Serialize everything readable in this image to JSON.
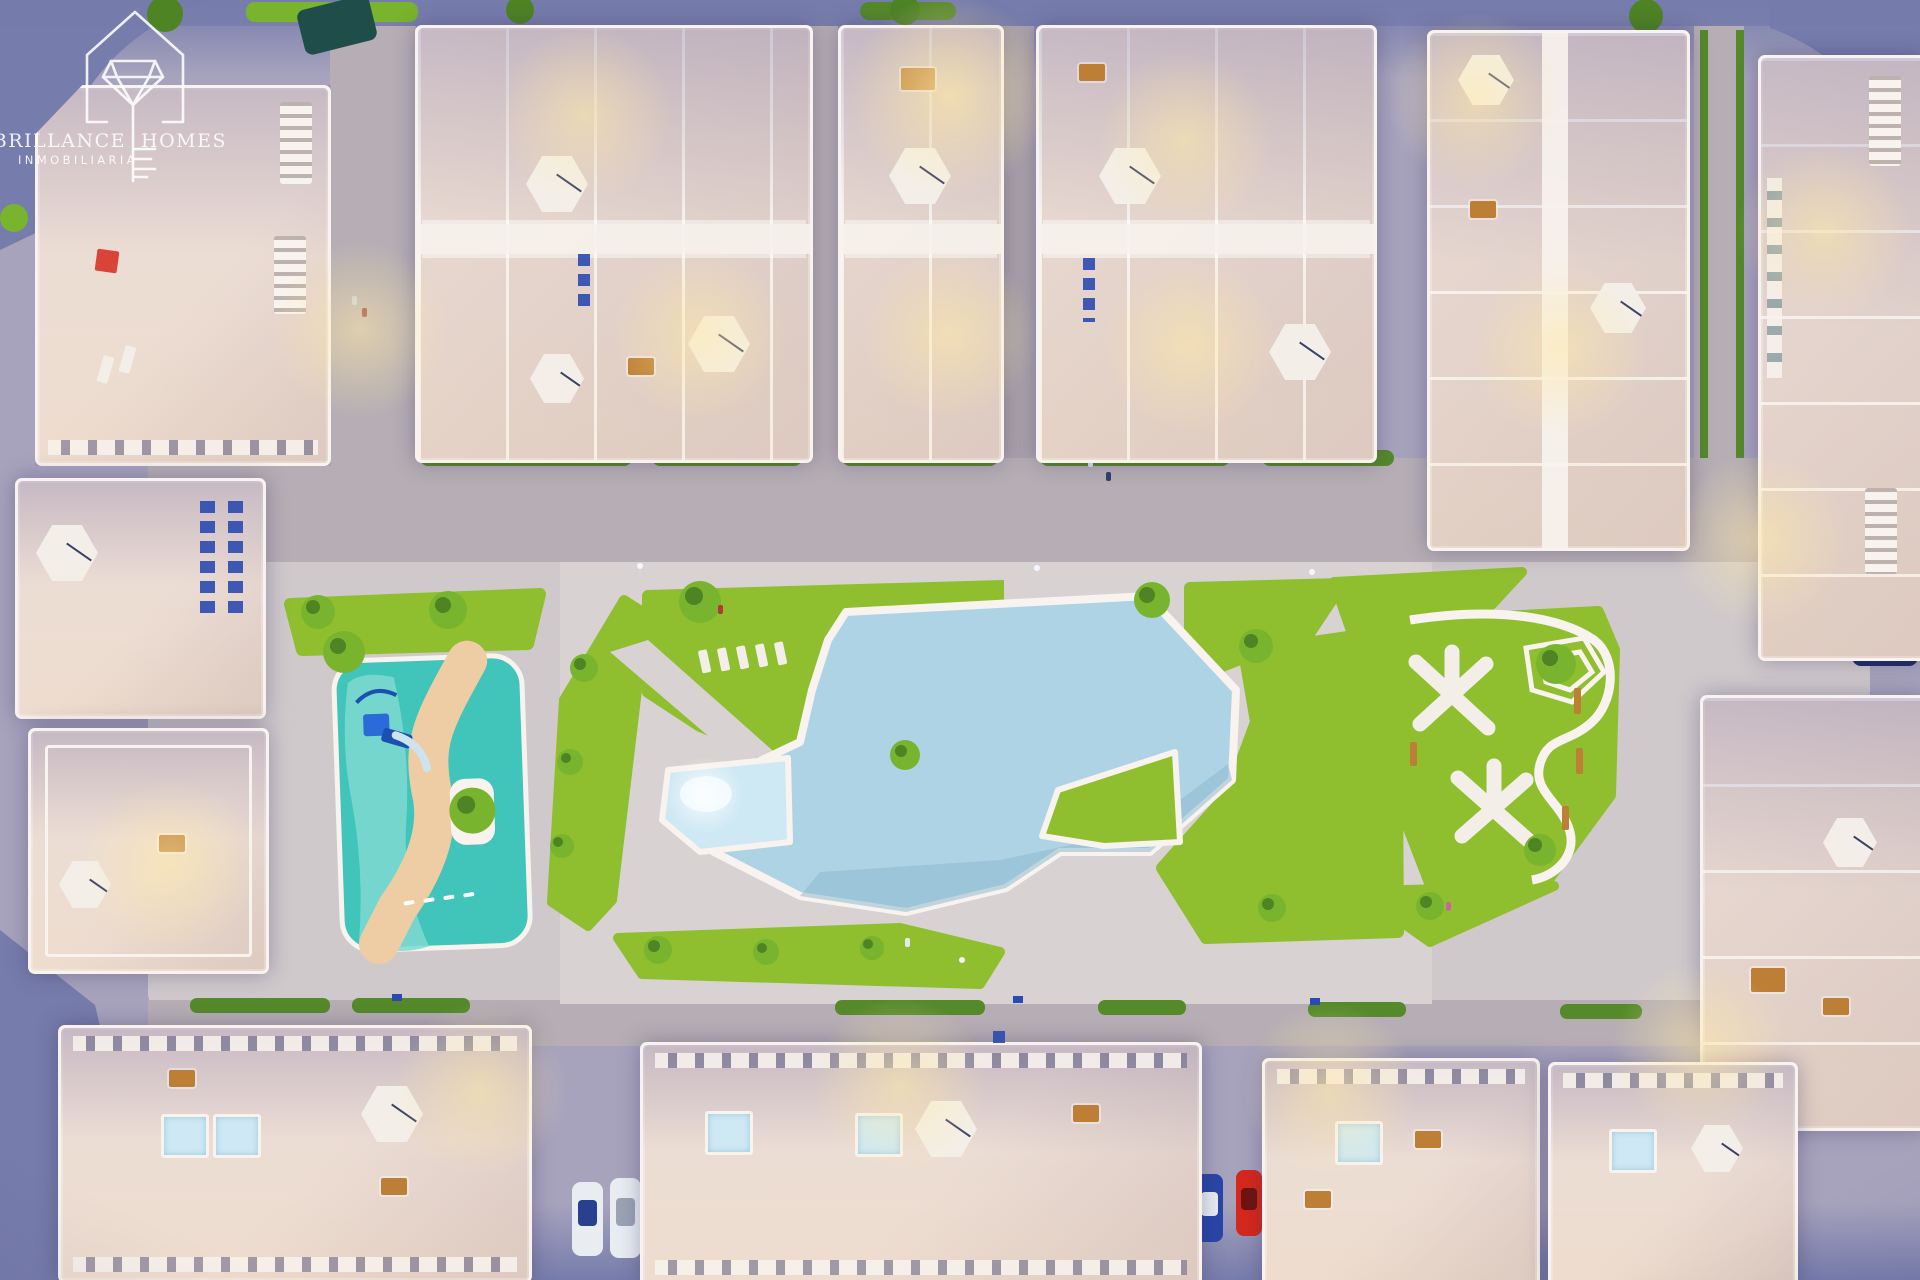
{
  "scene": {
    "description": "Aerial dusk 3D render of a residential complex: perimeter apartment blocks with rooftop terraces, central landscaped park with large swimming pool, children's splash playground, picnic lawns, streets with parked cars",
    "watermark_present": true
  },
  "watermark": {
    "brand_left": "BRILLANCE",
    "brand_right": "HOMES",
    "subtitle": "INMOBILIARIA",
    "icon": "diamond-house-key-logo-icon",
    "color": "#ffffff"
  },
  "palette": {
    "street": "#a7a3bd",
    "street-dark": "#767cab",
    "road-inner": "#b6aeb4",
    "deck": "#cfc9cc",
    "plaza": "#d8d2d3",
    "building": "#ecddd4",
    "building-edge": "#d9c8c4",
    "wall-white": "#f8f3ee",
    "lawn": "#8fbe2f",
    "hedge": "#55892a",
    "tree": "#79b42e",
    "tree-dark": "#4e8424",
    "pool": "#aed3e5",
    "pool-light": "#cfe9f4",
    "teal": "#41c4ba",
    "teal-light": "#7fd9d1",
    "sand": "#eecda4",
    "umbrella": "#f3efe8",
    "glow": "#ffe9a8",
    "wood": "#bd7f35",
    "sign-blue": "#2b4ab0",
    "car-red": "#d6281c",
    "car-blue": "#2946a8",
    "car-white": "#e9edf2",
    "car-navy": "#1d2d66",
    "watermark": "#ffffff"
  }
}
